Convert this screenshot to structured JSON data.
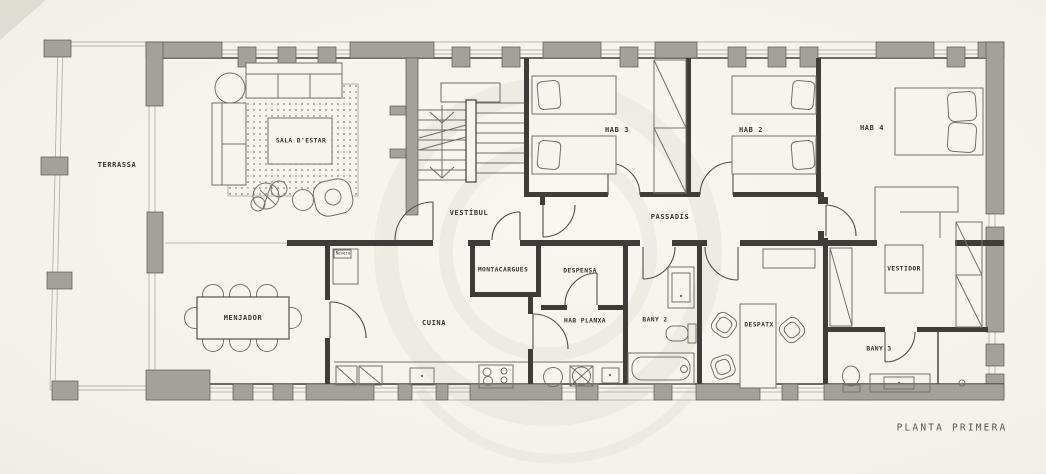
{
  "title": "PLANTA PRIMERA",
  "rooms": {
    "terrassa": {
      "label": "TERRASSA"
    },
    "sala_destar": {
      "label": "SALA D'ESTAR"
    },
    "vestibul": {
      "label": "VESTÍBUL"
    },
    "hab_3": {
      "label": "HAB 3"
    },
    "hab_2": {
      "label": "HAB 2"
    },
    "hab_4": {
      "label": "HAB 4"
    },
    "passadis": {
      "label": "PASSADÍS"
    },
    "menjador": {
      "label": "MENJADOR"
    },
    "cuina": {
      "label": "CUINA"
    },
    "montacargues": {
      "label": "MONTACARGUES"
    },
    "despensa": {
      "label": "DESPENSA"
    },
    "hab_planxa": {
      "label": "HAB PLANXA"
    },
    "bany_2": {
      "label": "BANY 2"
    },
    "despatx": {
      "label": "DESPATX"
    },
    "vestidor": {
      "label": "VESTIDOR"
    },
    "bany_3": {
      "label": "BANY 3"
    }
  },
  "annotations": {
    "fridge": "Nevera"
  },
  "colors": {
    "paper": "#f6f4ef",
    "wall": "#a3a19c",
    "ink": "#3f3d39",
    "furniture": "#73716c",
    "watermark": "#e7e4dd",
    "text": "#37352f"
  }
}
